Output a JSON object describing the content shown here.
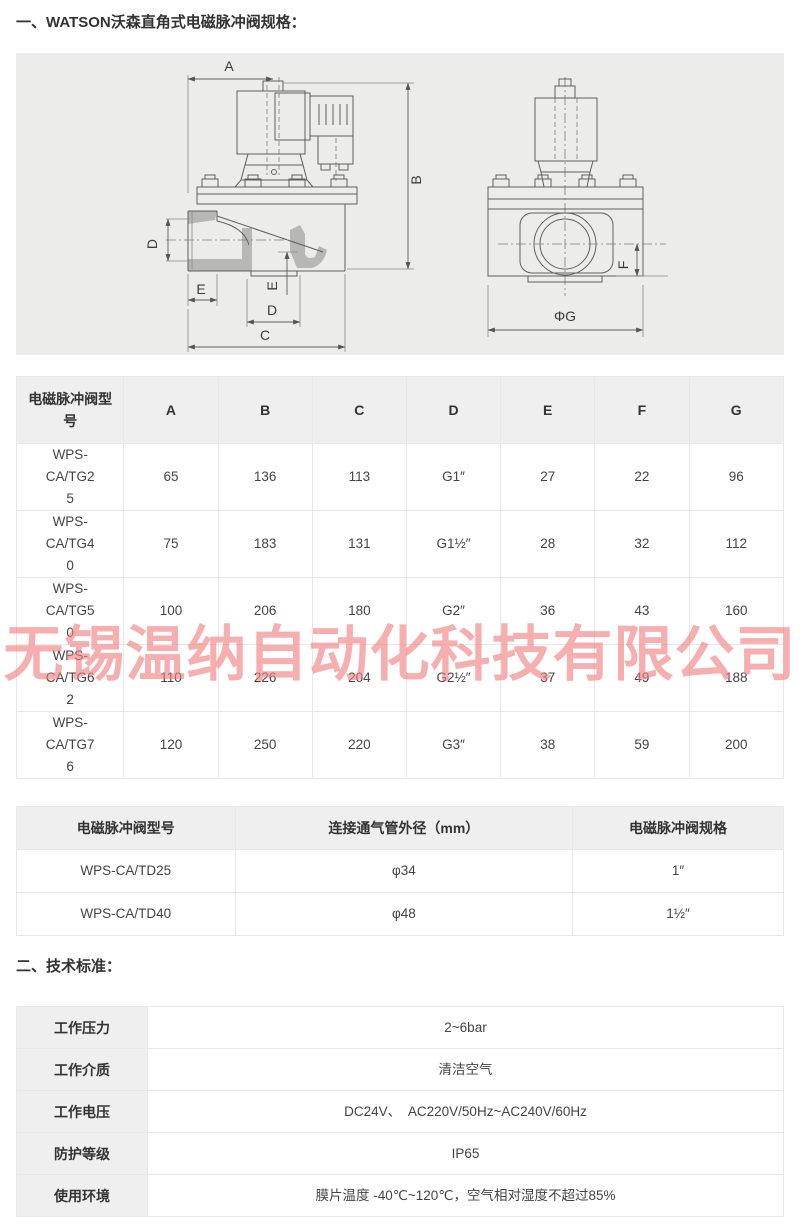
{
  "page": {
    "section1_title": "一、WATSON沃森直角式电磁脉冲阀规格：",
    "section2_title": "二、技术标准："
  },
  "colors": {
    "watermark": "#f27e7e",
    "table_header_bg": "#efefef",
    "table_border": "#e8e8e8",
    "drawing_bg": "#ececea"
  },
  "watermark": {
    "text": "无锡温纳自动化科技有限公司"
  },
  "drawing": {
    "labels": {
      "a": "A",
      "b": "B",
      "c": "C",
      "d": "D",
      "e": "E",
      "f": "F",
      "g": "ΦG"
    }
  },
  "dimension_table": {
    "headers": [
      "电磁脉冲阀型号",
      "A",
      "B",
      "C",
      "D",
      "E",
      "F",
      "G"
    ],
    "rows": [
      [
        "WPS-CA/TG25",
        "65",
        "136",
        "113",
        "G1″",
        "27",
        "22",
        "96"
      ],
      [
        "WPS-CA/TG40",
        "75",
        "183",
        "131",
        "G1½″",
        "28",
        "32",
        "112"
      ],
      [
        "WPS-CA/TG50",
        "100",
        "206",
        "180",
        "G2″",
        "36",
        "43",
        "160"
      ],
      [
        "WPS-CA/TG62",
        "110",
        "226",
        "204",
        "G2½″",
        "37",
        "49",
        "188"
      ],
      [
        "WPS-CA/TG76",
        "120",
        "250",
        "220",
        "G3″",
        "38",
        "59",
        "200"
      ]
    ]
  },
  "pipe_table": {
    "headers": [
      "电磁脉冲阀型号",
      "连接通气管外径（mm）",
      "电磁脉冲阀规格"
    ],
    "rows": [
      [
        "WPS-CA/TD25",
        "φ34",
        "1″"
      ],
      [
        "WPS-CA/TD40",
        "φ48",
        "1½″"
      ]
    ]
  },
  "spec_table": {
    "rows": [
      [
        "工作压力",
        "2~6bar"
      ],
      [
        "工作介质",
        "清洁空气"
      ],
      [
        "工作电压",
        "DC24V、　AC220V/50Hz~AC240V/60Hz"
      ],
      [
        "防护等级",
        "IP65"
      ],
      [
        "使用环境",
        "膜片温度 -40℃~120℃，空气相对湿度不超过85%"
      ]
    ]
  }
}
